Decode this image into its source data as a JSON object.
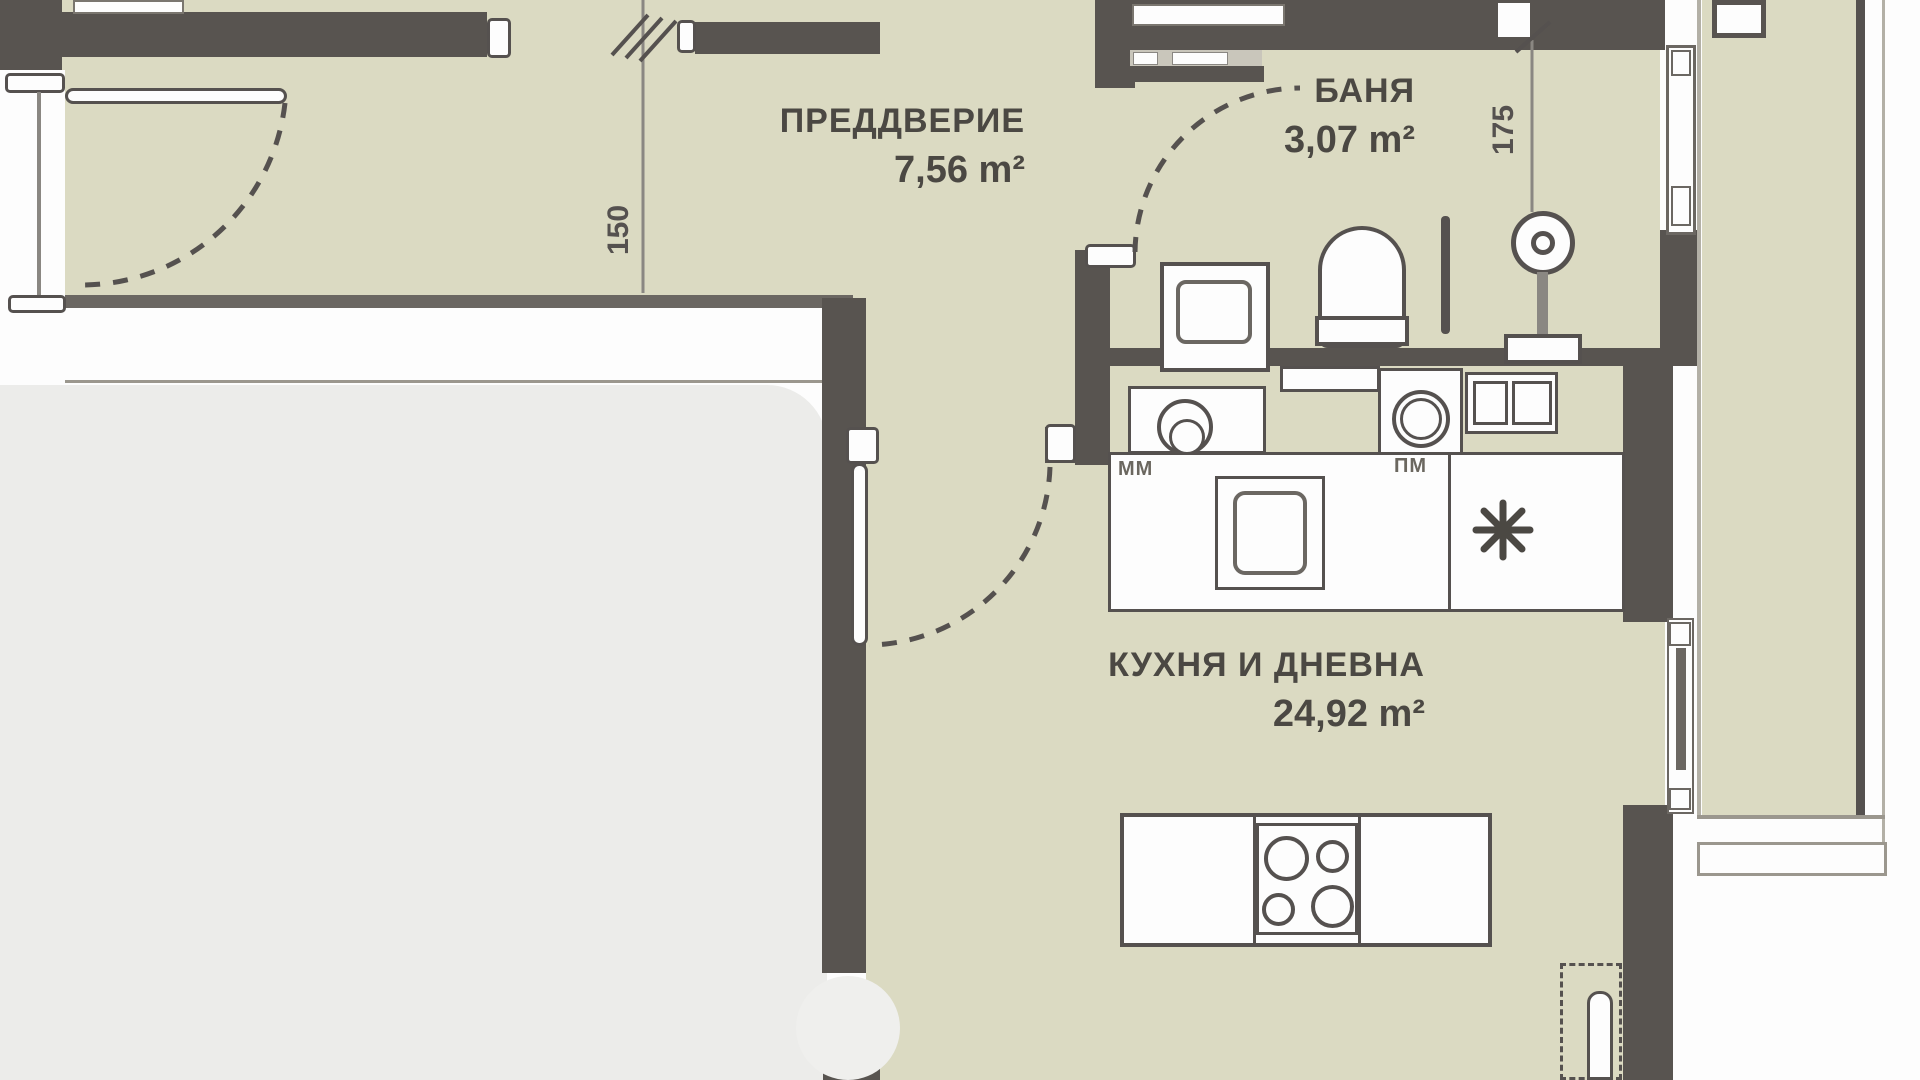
{
  "plan": {
    "rooms": [
      {
        "name": "ПРЕДДВЕРИЕ",
        "area": "7,56 m²"
      },
      {
        "name": "БАНЯ",
        "area": "3,07 m²"
      },
      {
        "name": "КУХНЯ И ДНЕВНА",
        "area": "24,92 m²"
      }
    ],
    "dimensions": {
      "hall_width": "150",
      "bath_width": "175"
    },
    "appliances": {
      "dishwasher": "ММ",
      "washing_machine": "ПМ"
    },
    "icons": {
      "fridge": "snowflake-asterisk-icon"
    },
    "colors": {
      "floor": "#dbdac2",
      "wall": "#585450",
      "outline": "#55514f",
      "furniture_white": "#fdfdfd",
      "soft_area": "#ececea",
      "text": "#4b4843",
      "dim_text": "#55514f"
    }
  }
}
